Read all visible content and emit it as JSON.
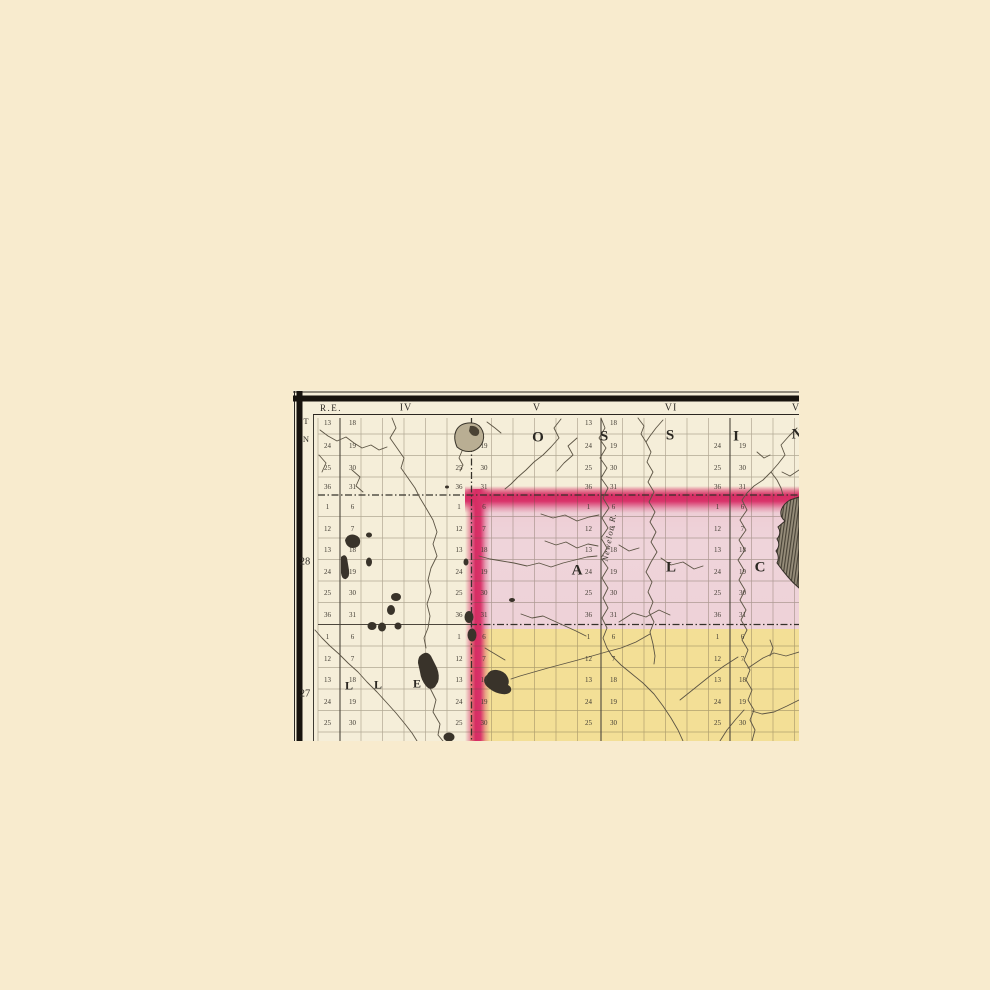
{
  "colors": {
    "background": "#f8ebce",
    "paper": "#f5eed9",
    "pink_wash": "#eed2d8",
    "yellow_wash": "#f3df96",
    "boundary_magenta": "#d62d63",
    "ink": "#2e2b25",
    "frame_black": "#17130e"
  },
  "frame": {
    "range_header": "R.E.",
    "township_header": [
      "T",
      "N"
    ],
    "range_numerals": [
      {
        "label": "IV",
        "x": 406
      },
      {
        "label": "V",
        "x": 537
      },
      {
        "label": "VI",
        "x": 671
      },
      {
        "label": "V",
        "x": 796
      }
    ],
    "township_row_numbers": [
      {
        "label": "28",
        "y": 562
      },
      {
        "label": "27",
        "y": 694
      }
    ]
  },
  "county_letters": [
    {
      "ch": "O",
      "x": 538,
      "y": 438,
      "size": 15
    },
    {
      "ch": "S",
      "x": 604,
      "y": 437,
      "size": 15
    },
    {
      "ch": "S",
      "x": 670,
      "y": 436,
      "size": 15
    },
    {
      "ch": "I",
      "x": 736,
      "y": 437,
      "size": 15
    },
    {
      "ch": "N",
      "x": 797,
      "y": 435,
      "size": 15
    },
    {
      "ch": "A",
      "x": 577,
      "y": 571,
      "size": 15
    },
    {
      "ch": "L",
      "x": 671,
      "y": 568,
      "size": 15
    },
    {
      "ch": "C",
      "x": 760,
      "y": 568,
      "size": 15
    },
    {
      "ch": "L",
      "x": 349,
      "y": 686,
      "size": 12
    },
    {
      "ch": "L",
      "x": 378,
      "y": 685,
      "size": 12
    },
    {
      "ch": "E",
      "x": 417,
      "y": 684,
      "size": 12
    }
  ],
  "river_label": {
    "text": "Newelon R.",
    "x": 609,
    "y": 537,
    "rotation": -80
  },
  "sections": {
    "line_x": [
      340,
      471.5,
      601,
      730
    ],
    "number_offset": 12.5,
    "bands": [
      {
        "rows": [
          423,
          446,
          468,
          487
        ],
        "left": [
          "13",
          "24",
          "25",
          "36"
        ],
        "right": [
          "18",
          "19",
          "30",
          "31"
        ]
      },
      {
        "rows": [
          507,
          528.5,
          550,
          571.5,
          593,
          614.5
        ],
        "left": [
          "1",
          "12",
          "13",
          "24",
          "25",
          "36"
        ],
        "right": [
          "6",
          "7",
          "18",
          "19",
          "30",
          "31"
        ]
      },
      {
        "rows": [
          637,
          658.5,
          680,
          701.5,
          723
        ],
        "left": [
          "1",
          "12",
          "13",
          "24",
          "25"
        ],
        "right": [
          "6",
          "7",
          "18",
          "19",
          "30"
        ]
      }
    ],
    "skips": [
      {
        "line_index": 1,
        "band": 0,
        "skip_left": [
          0,
          1
        ],
        "skip_right": [
          0
        ]
      },
      {
        "line_index": 3,
        "band": 0,
        "skip_left": [
          0
        ],
        "skip_right": [
          0
        ]
      }
    ]
  }
}
